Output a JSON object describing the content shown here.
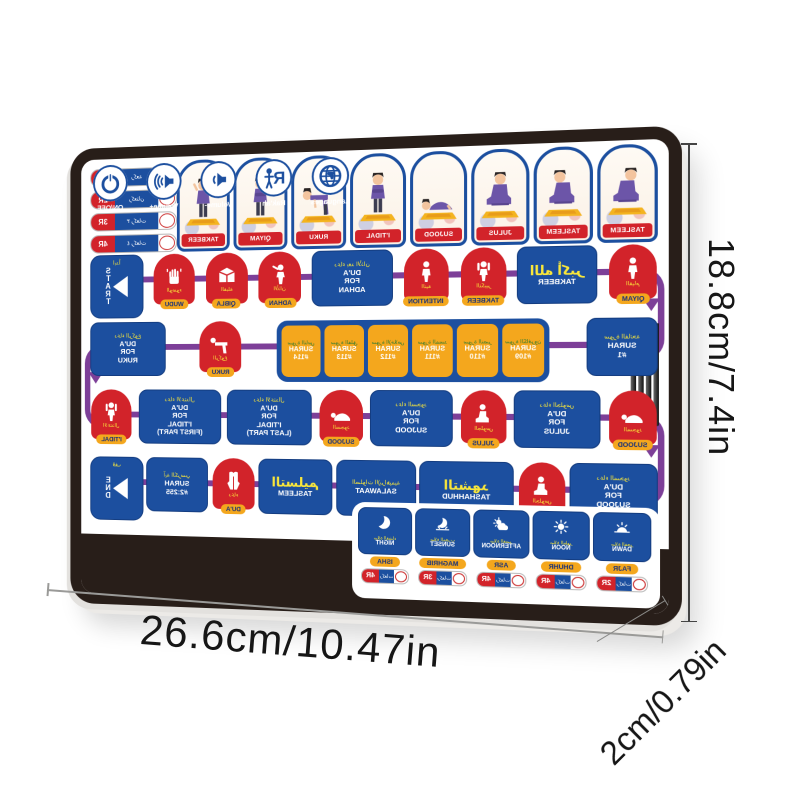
{
  "dimensions": {
    "width": "26.6cm/10.47in",
    "height": "18.8cm/7.4in",
    "depth": "2cm/0.79in"
  },
  "colors": {
    "blue": "#1c4f9f",
    "red": "#d2232a",
    "orange": "#f4a71d",
    "purple": "#7d3f98",
    "yellow": "#f9e73a",
    "green": "#2e7b33",
    "frame": "#281e19"
  },
  "tablet": {
    "mirrored_print": true,
    "rakah_toggles": [
      {
        "count": "1R",
        "ar": "ركعة"
      },
      {
        "count": "2R",
        "ar": "ركعتان"
      },
      {
        "count": "3R",
        "ar": "٣ ركعات"
      },
      {
        "count": "4R",
        "ar": "٤ ركعات"
      }
    ],
    "poses": [
      {
        "label": "TAKBEER",
        "pose": "takbeer"
      },
      {
        "label": "QIYAM",
        "pose": "qiyam"
      },
      {
        "label": "RUKU",
        "pose": "ruku"
      },
      {
        "label": "I'TIDAL",
        "pose": "itidal"
      },
      {
        "label": "SUJOOD",
        "pose": "sujood"
      },
      {
        "label": "JULUS",
        "pose": "julus"
      },
      {
        "label": "TASLEEM",
        "pose": "tasleem_r"
      },
      {
        "label": "TASLEEM",
        "pose": "tasleem_l"
      }
    ],
    "row2": [
      {
        "t": "start",
        "label": "START",
        "ar": "ابدأ"
      },
      {
        "t": "arch",
        "icon": "wudu",
        "ar": "الوضوء",
        "label": "WUDU"
      },
      {
        "t": "arch",
        "icon": "kaaba",
        "ar": "القبلة",
        "label": "QIBLA"
      },
      {
        "t": "arch",
        "icon": "muezzin",
        "ar": "الأذان",
        "label": "ADHAN"
      },
      {
        "t": "dua",
        "ar": "دعاء بعد الأذان",
        "lines": [
          "DU'A",
          "FOR",
          "ADHAN"
        ]
      },
      {
        "t": "arch",
        "icon": "stand",
        "ar": "النية",
        "label": "INTENTION"
      },
      {
        "t": "arch",
        "icon": "handsup",
        "ar": "التكبير",
        "label": "TAKBEER"
      },
      {
        "t": "bigar",
        "ar": "الله أكبر",
        "label": "TAKBEER"
      },
      {
        "t": "arch",
        "icon": "stand",
        "ar": "القيام",
        "label": "QIYAM"
      }
    ],
    "row3": [
      {
        "t": "dua",
        "ar": "دعاء الركوع",
        "lines": [
          "DU'A",
          "FOR",
          "RUKU"
        ]
      },
      {
        "t": "arch",
        "icon": "bow",
        "ar": "الركوع",
        "label": "RUKU"
      },
      {
        "t": "surahgroup",
        "items": [
          {
            "ar": "سورة الناس",
            "label": "SURAH",
            "num": "#114"
          },
          {
            "ar": "سورة الفلق",
            "label": "SURAH",
            "num": "#113"
          },
          {
            "ar": "سورة الإخلاص",
            "label": "SURAH",
            "num": "#112"
          },
          {
            "ar": "سورة المسد",
            "label": "SURAH",
            "num": "#111"
          },
          {
            "ar": "سورة النصر",
            "label": "SURAH",
            "num": "#110"
          },
          {
            "ar": "سورة الكافرون",
            "label": "SURAH",
            "num": "#109"
          }
        ]
      },
      {
        "t": "surah",
        "ar": "سورة الفاتحة",
        "label": "SURAH",
        "num": "#1"
      }
    ],
    "row4": [
      {
        "t": "arch",
        "icon": "handsup",
        "ar": "الاعتدال",
        "label": "I'TIDAL"
      },
      {
        "t": "dua",
        "ar": "دعاء الاعتدال",
        "lines": [
          "DU'A",
          "FOR",
          "I'TIDAL",
          "(FIRST PART)"
        ]
      },
      {
        "t": "dua",
        "ar": "دعاء الاعتدال",
        "lines": [
          "DU'A",
          "FOR",
          "I'TIDAL",
          "(LAST PART)"
        ]
      },
      {
        "t": "arch",
        "icon": "prostrate",
        "ar": "السجود",
        "label": "SUJOOD"
      },
      {
        "t": "dua",
        "ar": "دعاء السجود",
        "lines": [
          "DU'A",
          "FOR",
          "SUJOOD"
        ]
      },
      {
        "t": "arch",
        "icon": "sit",
        "ar": "الجلوس",
        "label": "JULUS"
      },
      {
        "t": "dua",
        "ar": "دعاء الجلوس",
        "lines": [
          "DU'A",
          "FOR",
          "JULUS"
        ]
      },
      {
        "t": "arch",
        "icon": "prostrate",
        "ar": "السجود",
        "label": "SUJOOD"
      }
    ],
    "row5": [
      {
        "t": "end",
        "label": "END",
        "ar": "قف"
      },
      {
        "t": "surah",
        "ar": "آية الكرسي",
        "label": "SURAH",
        "num": "#2:255"
      },
      {
        "t": "arch",
        "icon": "duahands",
        "ar": "دعاء",
        "label": "DU'A"
      },
      {
        "t": "bigar",
        "ar": "التسليم",
        "label": "TASLEEM"
      },
      {
        "t": "dua",
        "ar": "الصلوات الإبراهيمية",
        "lines": [
          "SALAWAAT"
        ]
      },
      {
        "t": "bigar",
        "ar": "التشهد",
        "label": "TASHAHHUD"
      },
      {
        "t": "arch",
        "icon": "sit",
        "ar": "الجلوس",
        "label": "JULUS"
      },
      {
        "t": "dua",
        "ar": "دعاء السجود",
        "lines": [
          "DU'A",
          "FOR",
          "SUJOOD"
        ]
      }
    ],
    "controls": [
      {
        "icon": "power",
        "label": "ON/OFF"
      },
      {
        "icon": "vol-plus",
        "label": "Volume+"
      },
      {
        "icon": "vol-minus",
        "label": "Volume-"
      },
      {
        "icon": "rakah",
        "label": "Rak'ah"
      },
      {
        "icon": "globe",
        "label": "Languages"
      }
    ],
    "prayer_times": [
      {
        "icon": "moon",
        "ar": "صلاة العشاء",
        "label": "NIGHT",
        "name": "ISHA",
        "rak": "4R",
        "rak_ar": "ركعات"
      },
      {
        "icon": "sunset",
        "ar": "صلاة المغرب",
        "label": "SUNSET",
        "name": "MAGHRIB",
        "rak": "3R",
        "rak_ar": "ركعات"
      },
      {
        "icon": "cloud-sun",
        "ar": "صلاة العصر",
        "label": "AFTERNOON",
        "name": "ASR",
        "rak": "4R",
        "rak_ar": "ركعات"
      },
      {
        "icon": "sun",
        "ar": "صلاة الظهر",
        "label": "NOON",
        "name": "DHUHR",
        "rak": "4R",
        "rak_ar": "ركعات"
      },
      {
        "icon": "dawn",
        "ar": "صلاة الفجر",
        "label": "DAWN",
        "name": "FAJR",
        "rak": "2R",
        "rak_ar": "ركعات"
      }
    ]
  }
}
